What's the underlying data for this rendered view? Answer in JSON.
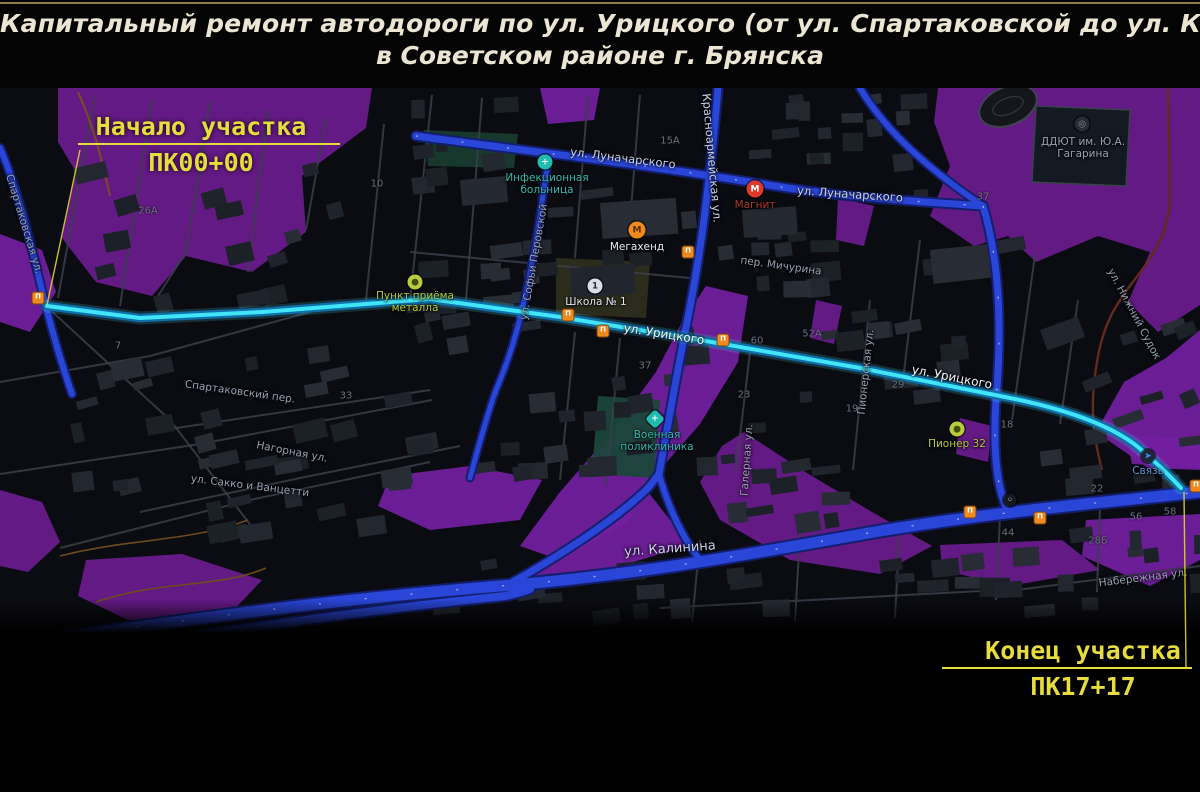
{
  "title": {
    "line1": "Капитальный ремонт автодороги по ул. Урицкого (от ул. Спартаковской до ул. Калинина)",
    "line2": "в Советском районе г. Брянска"
  },
  "annotations": {
    "start": {
      "label": "Начало участка",
      "station": "ПК00+00"
    },
    "end": {
      "label": "Конец участка",
      "station": "ПК17+17"
    }
  },
  "map": {
    "colors": {
      "background": "#0b0c12",
      "vegetation": "#6b1c8e",
      "vegetation_alt": "#731fa0",
      "road": "#2a46d8",
      "road_casing": "#131f6e",
      "route": "#41e5f7",
      "route_casing": "#0f6fa8",
      "annotation": "#e7dc3e"
    },
    "street_labels": [
      {
        "t": "Спартаковская ул.",
        "x": 24,
        "y": 224,
        "r": 73,
        "k": ""
      },
      {
        "t": "Спартаковский пер.",
        "x": 240,
        "y": 392,
        "r": 8,
        "k": ""
      },
      {
        "t": "Нагорная ул.",
        "x": 292,
        "y": 452,
        "r": 11,
        "k": ""
      },
      {
        "t": "ул. Сакко и Ванцетти",
        "x": 250,
        "y": 486,
        "r": 7,
        "k": ""
      },
      {
        "t": "ул. Луначарского",
        "x": 623,
        "y": 158,
        "r": 7,
        "k": "bright"
      },
      {
        "t": "ул. Луначарского",
        "x": 850,
        "y": 194,
        "r": 4,
        "k": "bright"
      },
      {
        "t": "Красноармейская ул.",
        "x": 712,
        "y": 158,
        "r": 85,
        "k": "bright"
      },
      {
        "t": "ул. Софьи Перовской",
        "x": 534,
        "y": 262,
        "r": -80,
        "k": ""
      },
      {
        "t": "ул. Урицкого",
        "x": 664,
        "y": 334,
        "r": 9,
        "k": "route"
      },
      {
        "t": "ул. Урицкого",
        "x": 952,
        "y": 377,
        "r": 11,
        "k": "route"
      },
      {
        "t": "ул. Калинина",
        "x": 670,
        "y": 549,
        "r": -4,
        "k": "major"
      },
      {
        "t": "Пионерская ул.",
        "x": 866,
        "y": 372,
        "r": -84,
        "k": ""
      },
      {
        "t": "Галерная ул.",
        "x": 747,
        "y": 460,
        "r": -86,
        "k": ""
      },
      {
        "t": "пер. Мичурина",
        "x": 781,
        "y": 266,
        "r": 8,
        "k": ""
      },
      {
        "t": "ул. Нижний Судок",
        "x": 1134,
        "y": 314,
        "r": 62,
        "k": ""
      },
      {
        "t": "Набережная ул.",
        "x": 1143,
        "y": 578,
        "r": -7,
        "k": ""
      }
    ],
    "pois": [
      {
        "id": "infekcionnaya-bolnica",
        "label": "Инфекционная\nбольница",
        "x": 545,
        "y": 162,
        "lx": 547,
        "ly": 172,
        "shape": "circle",
        "size": 15,
        "color": "#1fbdb0",
        "glyph": "+",
        "gcolor": "#ffffff",
        "lcolor": "#35b8ac"
      },
      {
        "id": "megahend",
        "label": "Мегахенд",
        "x": 637,
        "y": 230,
        "lx": 637,
        "ly": 241,
        "shape": "circle",
        "size": 17,
        "color": "#f08a1c",
        "glyph": "М",
        "gcolor": "#5a3000",
        "lcolor": "#e8edf5"
      },
      {
        "id": "magnit",
        "label": "Магнит",
        "x": 755,
        "y": 189,
        "lx": 755,
        "ly": 199,
        "shape": "circle",
        "size": 17,
        "color": "#e0392a",
        "glyph": "М",
        "gcolor": "#ffffff",
        "lcolor": "#ab3a2c"
      },
      {
        "id": "shkola-1",
        "label": "Школа № 1",
        "x": 595,
        "y": 286,
        "lx": 596,
        "ly": 296,
        "shape": "circle",
        "size": 15,
        "color": "#d8dde8",
        "glyph": "1",
        "gcolor": "#2b2f38",
        "lcolor": "#dfe5f0"
      },
      {
        "id": "punkt-priyoma-metalla",
        "label": "Пункт приёма\nметалла",
        "x": 415,
        "y": 282,
        "lx": 415,
        "ly": 290,
        "shape": "circle",
        "size": 15,
        "color": "#b8cc3e",
        "glyph": "●",
        "gcolor": "#434d10",
        "lcolor": "#b4c83c"
      },
      {
        "id": "voennaya-poliklinika",
        "label": "Военная\nполиклиника",
        "x": 655,
        "y": 419,
        "lx": 657,
        "ly": 429,
        "shape": "diamond",
        "size": 14,
        "color": "#1fbdb0",
        "glyph": "+",
        "gcolor": "#ffffff",
        "lcolor": "#35b8ac"
      },
      {
        "id": "pioner-32",
        "label": "Пионер 32",
        "x": 957,
        "y": 429,
        "lx": 957,
        "ly": 438,
        "shape": "circle",
        "size": 15,
        "color": "#b8cc3e",
        "glyph": "●",
        "gcolor": "#434d10",
        "lcolor": "#b4c83c"
      },
      {
        "id": "ddyut-gagarina",
        "label": "ДДЮТ им. Ю.А.\nГагарина",
        "x": 1082,
        "y": 124,
        "lx": 1083,
        "ly": 136,
        "shape": "circle",
        "size": 15,
        "color": "#262c35",
        "glyph": "◎",
        "gcolor": "#8b93a4",
        "lcolor": "#99a1b2"
      },
      {
        "id": "svyaz",
        "label": "Связь",
        "x": 1148,
        "y": 456,
        "lx": 1148,
        "ly": 465,
        "shape": "circle",
        "size": 13,
        "color": "#1d2733",
        "glyph": "➤",
        "gcolor": "#3f8cf0",
        "lcolor": "#5d93d8"
      },
      {
        "id": "poi-kalinina",
        "label": "",
        "x": 1010,
        "y": 500,
        "lx": 1010,
        "ly": 508,
        "shape": "circle",
        "size": 13,
        "color": "#14181f",
        "glyph": "◦",
        "gcolor": "#cfd6e0",
        "lcolor": "#888"
      }
    ],
    "transit_stops": [
      {
        "x": 38,
        "y": 298
      },
      {
        "x": 568,
        "y": 315
      },
      {
        "x": 603,
        "y": 331
      },
      {
        "x": 688,
        "y": 252
      },
      {
        "x": 723,
        "y": 340
      },
      {
        "x": 970,
        "y": 512
      },
      {
        "x": 1040,
        "y": 518
      },
      {
        "x": 1196,
        "y": 486
      }
    ],
    "building_numbers": [
      {
        "t": "26А",
        "x": 148,
        "y": 211
      },
      {
        "t": "10",
        "x": 377,
        "y": 184
      },
      {
        "t": "15А",
        "x": 670,
        "y": 141
      },
      {
        "t": "37",
        "x": 983,
        "y": 197
      },
      {
        "t": "37",
        "x": 645,
        "y": 366
      },
      {
        "t": "60",
        "x": 757,
        "y": 341
      },
      {
        "t": "52А",
        "x": 812,
        "y": 334
      },
      {
        "t": "29",
        "x": 898,
        "y": 385
      },
      {
        "t": "18",
        "x": 1007,
        "y": 425
      },
      {
        "t": "22",
        "x": 1097,
        "y": 489
      },
      {
        "t": "56",
        "x": 1136,
        "y": 517
      },
      {
        "t": "58",
        "x": 1170,
        "y": 512
      },
      {
        "t": "44",
        "x": 1008,
        "y": 533
      },
      {
        "t": "28Б",
        "x": 1098,
        "y": 541
      },
      {
        "t": "23",
        "x": 744,
        "y": 395
      },
      {
        "t": "19",
        "x": 852,
        "y": 409
      },
      {
        "t": "7",
        "x": 118,
        "y": 346
      },
      {
        "t": "33",
        "x": 346,
        "y": 396
      }
    ]
  }
}
